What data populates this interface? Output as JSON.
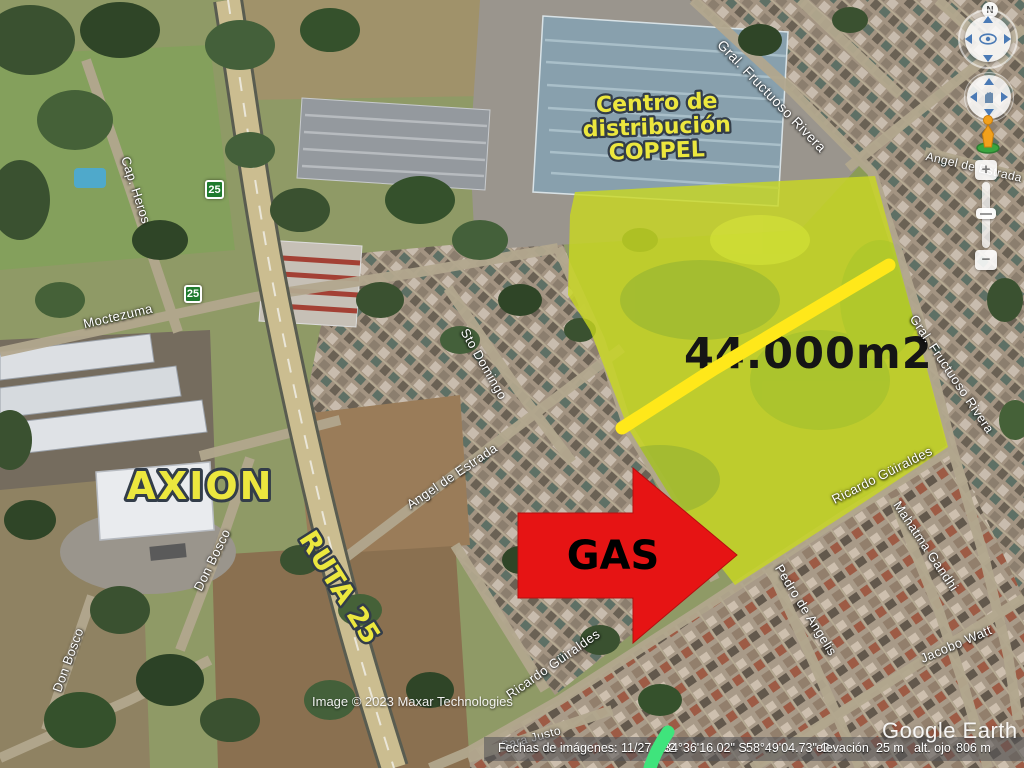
{
  "annotations": {
    "coppel_line1": "Centro de",
    "coppel_line2": "distribución",
    "coppel_line3": "COPPEL",
    "area_label": "44.000m2",
    "gas_label": "GAS",
    "axion_label": "AXION",
    "ruta_label": "RUTA 25"
  },
  "streets": [
    {
      "name": "Gral. Fructuoso Rivera",
      "x": 772,
      "y": 96,
      "rot": 46,
      "size": 14
    },
    {
      "name": "Gral. Fructuoso Rivera",
      "x": 952,
      "y": 374,
      "rot": 56,
      "size": 13
    },
    {
      "name": "Moctezuma",
      "x": 118,
      "y": 316,
      "rot": -13,
      "size": 13
    },
    {
      "name": "Cap. Heros",
      "x": 136,
      "y": 190,
      "rot": 72,
      "size": 13
    },
    {
      "name": "Sto Domingo",
      "x": 484,
      "y": 364,
      "rot": 60,
      "size": 13
    },
    {
      "name": "Angel de Estrada",
      "x": 452,
      "y": 476,
      "rot": -34,
      "size": 13
    },
    {
      "name": "Angel de Estrada",
      "x": 974,
      "y": 167,
      "rot": 13,
      "size": 12
    },
    {
      "name": "Don Bosco",
      "x": 212,
      "y": 560,
      "rot": -64,
      "size": 13
    },
    {
      "name": "Don Bosco",
      "x": 68,
      "y": 660,
      "rot": -70,
      "size": 13
    },
    {
      "name": "Ricardo Güiraldes",
      "x": 553,
      "y": 664,
      "rot": -35,
      "size": 13
    },
    {
      "name": "Ricardo Güiraldes",
      "x": 882,
      "y": 475,
      "rot": -27,
      "size": 13
    },
    {
      "name": "Mahatma Gandhi",
      "x": 926,
      "y": 546,
      "rot": 56,
      "size": 13
    },
    {
      "name": "Pedro de Angelis",
      "x": 806,
      "y": 610,
      "rot": 58,
      "size": 13
    },
    {
      "name": "Jacobo Watt",
      "x": 956,
      "y": 644,
      "rot": -23,
      "size": 13
    },
    {
      "name": "Sara Justo",
      "x": 531,
      "y": 738,
      "rot": -15,
      "size": 12
    }
  ],
  "route_shields": [
    {
      "label": "25",
      "x": 205,
      "y": 180,
      "size": 19
    },
    {
      "label": "25",
      "x": 184,
      "y": 285,
      "size": 18
    }
  ],
  "navigation": {
    "north": "N",
    "zoom_in": "+",
    "zoom_out": "−"
  },
  "status_bar": {
    "imagery_dates": "Fechas de imágenes: 11/27/202",
    "latitude": "34°36'16.02\" S",
    "longitude": "58°49'04.73\" O",
    "elevation_label": "elevación",
    "elevation_value": "25 m",
    "eye_alt_label": "alt. ojo",
    "eye_alt_value": "806 m"
  },
  "credits": {
    "imagery_credit": "Image © 2023 Maxar Technologies",
    "app_logo": "Google Earth"
  },
  "colors": {
    "parcel_overlay": "#c9d81f",
    "highlight_line": "#ffe81a",
    "gas_arrow": "#e61414",
    "label_yellow": "#ece73e",
    "route_shield_green": "#1f7a2e",
    "bottom_stroke_green": "#3fe47c"
  }
}
